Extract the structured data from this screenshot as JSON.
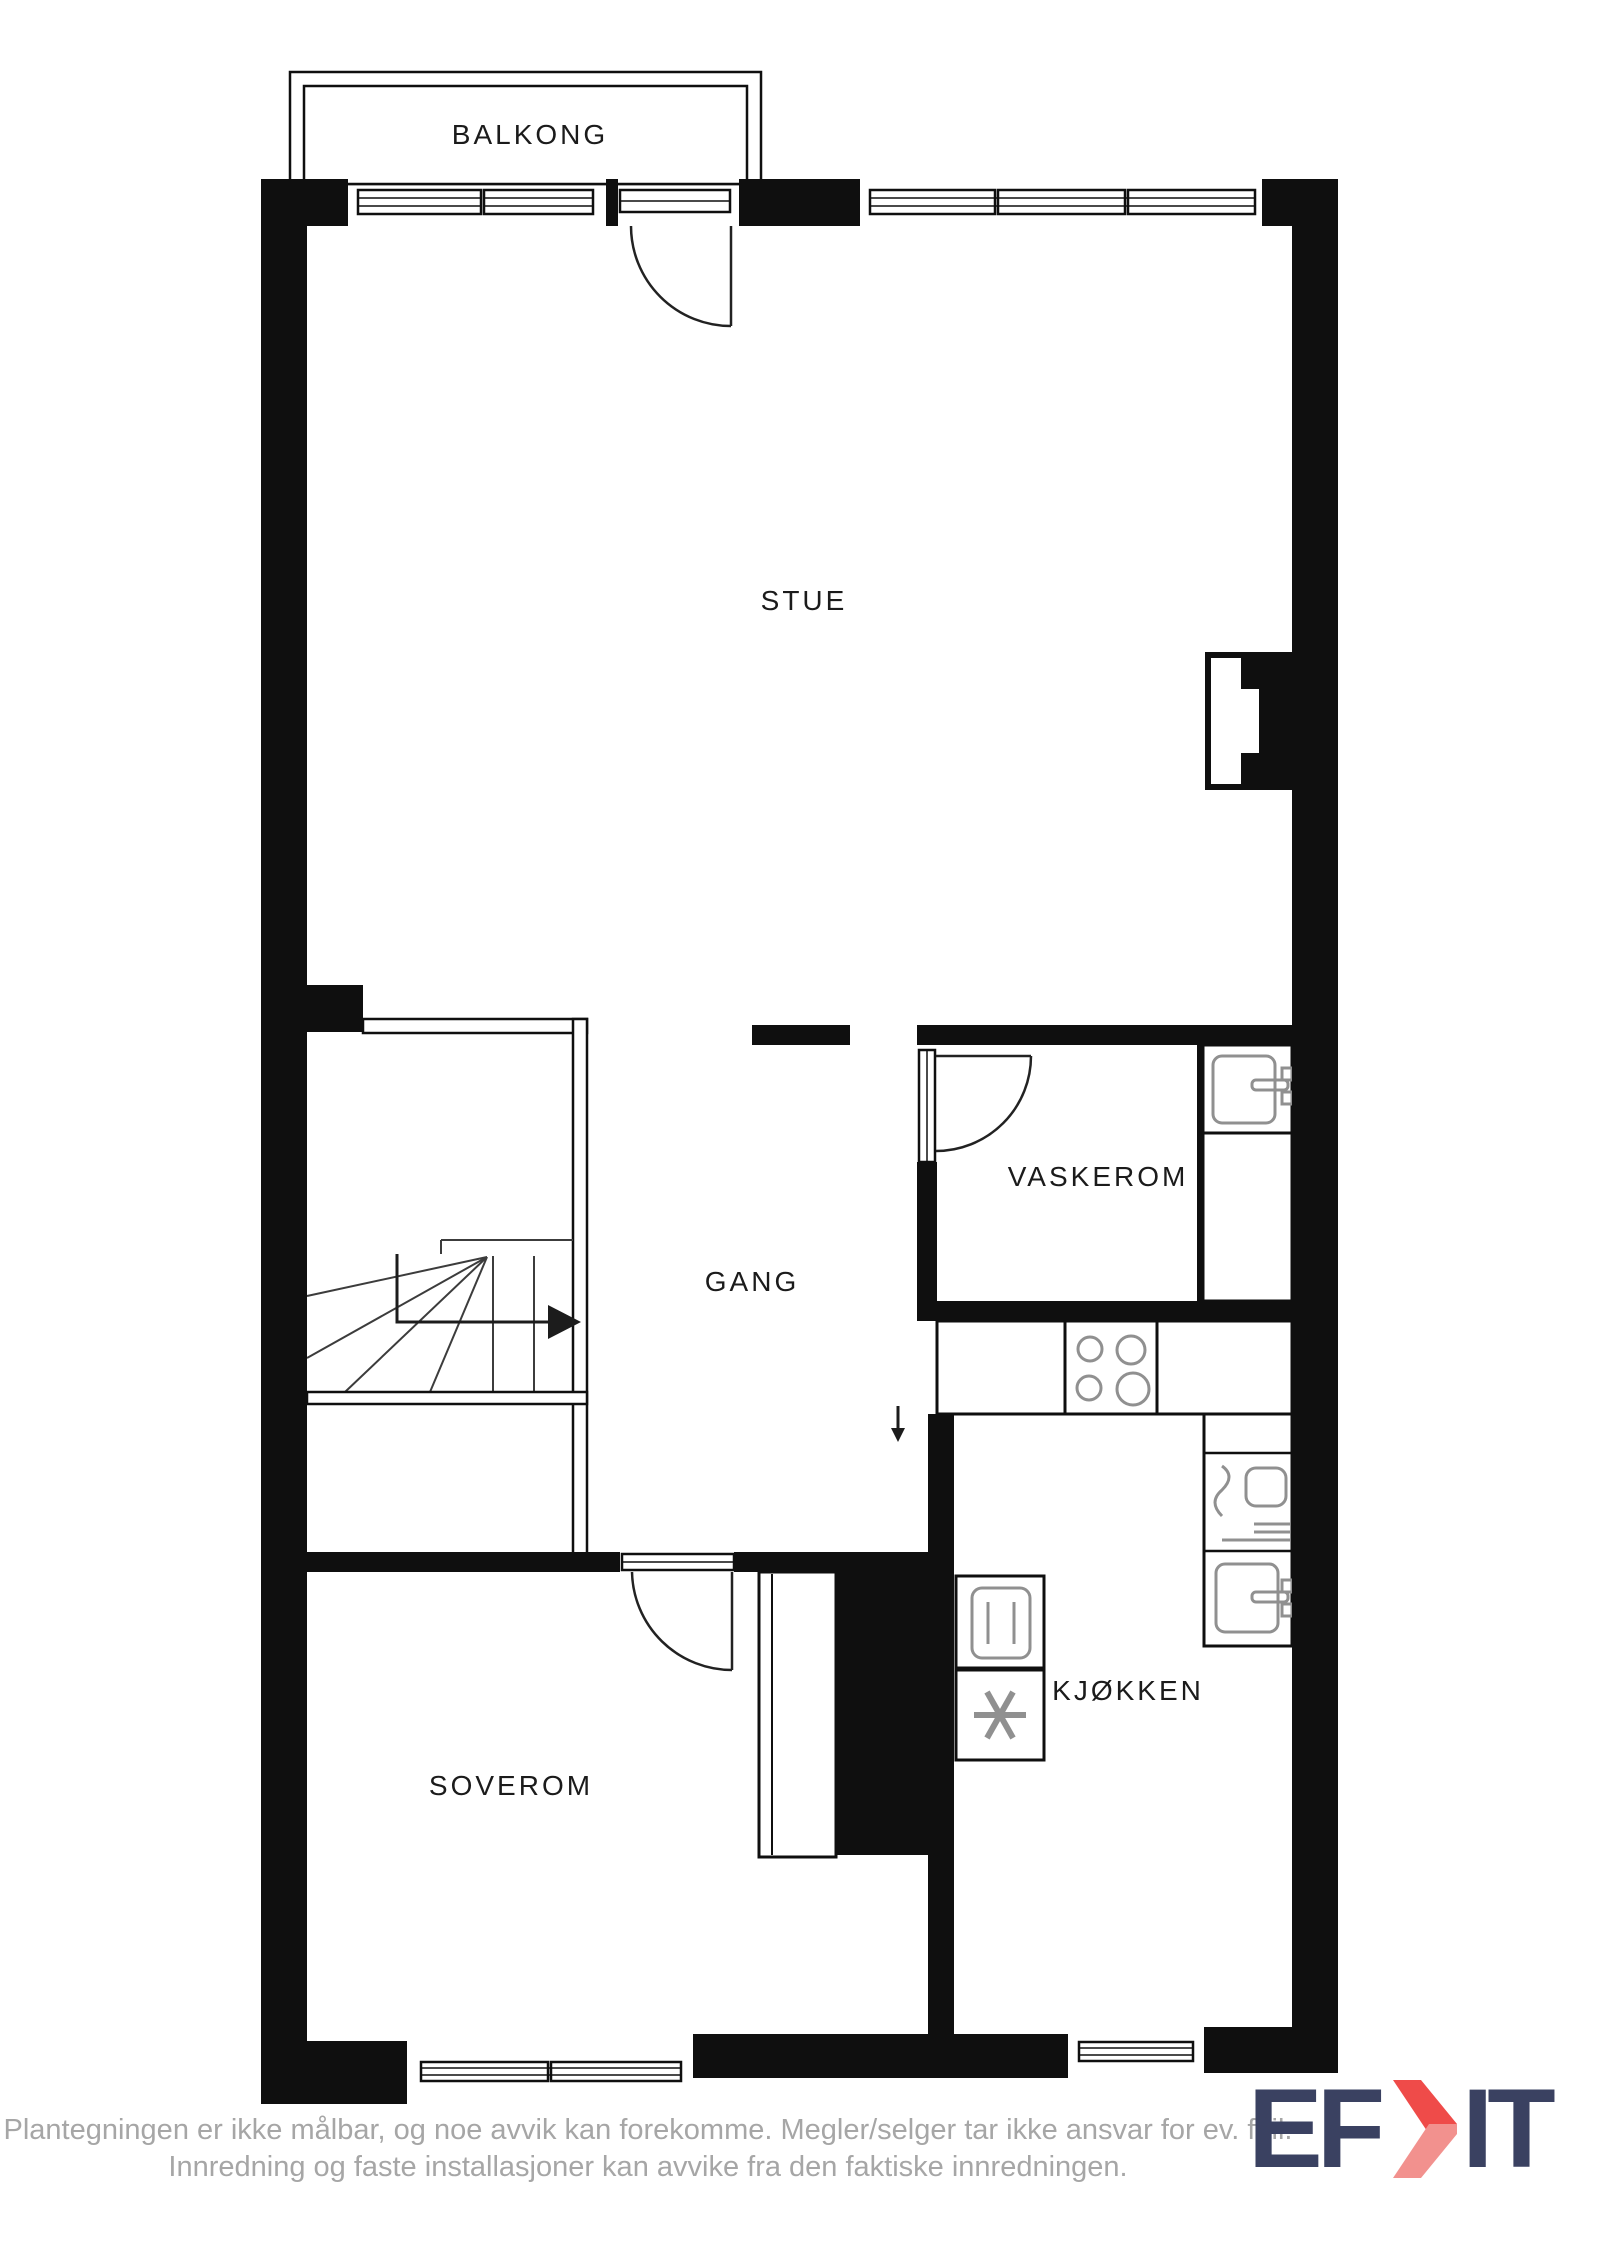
{
  "plan": {
    "labels": {
      "balkong": "BALKONG",
      "stue": "STUE",
      "gang": "GANG",
      "vaskerom": "VASKEROM",
      "kjokken": "KJØKKEN",
      "soverom": "SOVEROM"
    },
    "colors": {
      "wall": "#0f0f0f",
      "fixture_line": "#909090",
      "label_text": "#1b1b1b"
    }
  },
  "footer": {
    "line1": "Plantegningen er ikke målbar, og noe avvik kan forekomme. Megler/selger tar ikke ansvar for ev. feil.",
    "line2": "Innredning og faste installasjoner kan avvike fra den faktiske innredningen.",
    "text_color": "#a6a6a6"
  },
  "logo": {
    "text_left": "EF",
    "text_right": "IT",
    "chevron_icon": "chevron-right-icon",
    "navy": "#3a4161",
    "red": "#ef4b49",
    "red_light": "#f2918e"
  }
}
